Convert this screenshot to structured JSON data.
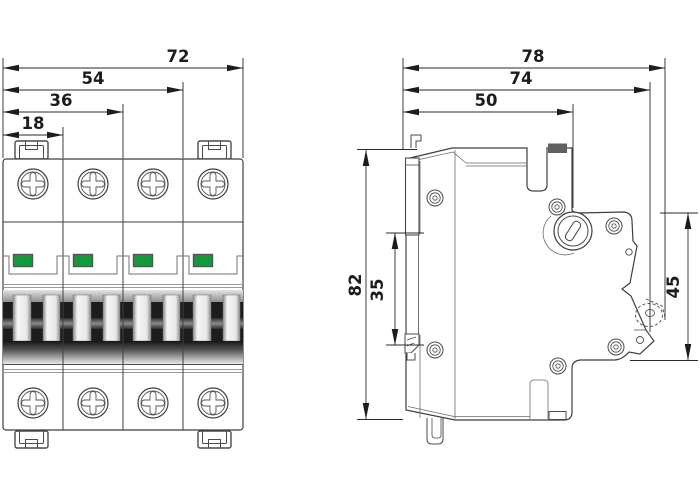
{
  "dimensions": {
    "front": {
      "overall_width": "72",
      "width_three_poles": "54",
      "width_two_poles": "36",
      "pole_width": "18"
    },
    "side": {
      "overall_depth": "78",
      "depth_to_lever": "74",
      "housing_depth": "50",
      "overall_height": "82",
      "din_slot_height": "35",
      "front_section_height": "45"
    }
  },
  "colors": {
    "indicator_green": "#14993c",
    "outline_gray": "#3f3f3f",
    "dimension_black": "#1c1c1c"
  }
}
